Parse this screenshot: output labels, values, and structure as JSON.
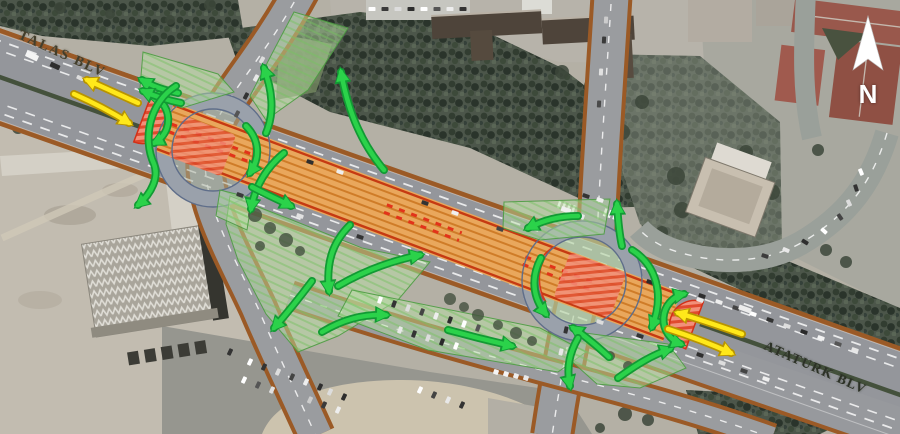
{
  "labels": {
    "talas": "TALAS BLV",
    "ataturk": "ATATURK BLV"
  },
  "compass": {
    "label": "N"
  },
  "overlay": {
    "bus_corridor_color": "#e9a75c",
    "corridor_stripe_color": "#cf7c28",
    "corridor_edge_color": "#c63a12",
    "red_dash_color": "#e2331a",
    "restricted_zone_color": "#f2907a",
    "restricted_hatch_color": "#e04a2e",
    "green_zone_fill": "#b9e2a6",
    "green_zone_hatch": "#7cc468",
    "turn_arrow_color": "#2bd24a",
    "turn_arrow_outline": "#129a34",
    "lane_arrow_color": "#ffe81a",
    "lane_arrow_outline": "#b89400",
    "road_edge_color": "#9b5a26"
  }
}
